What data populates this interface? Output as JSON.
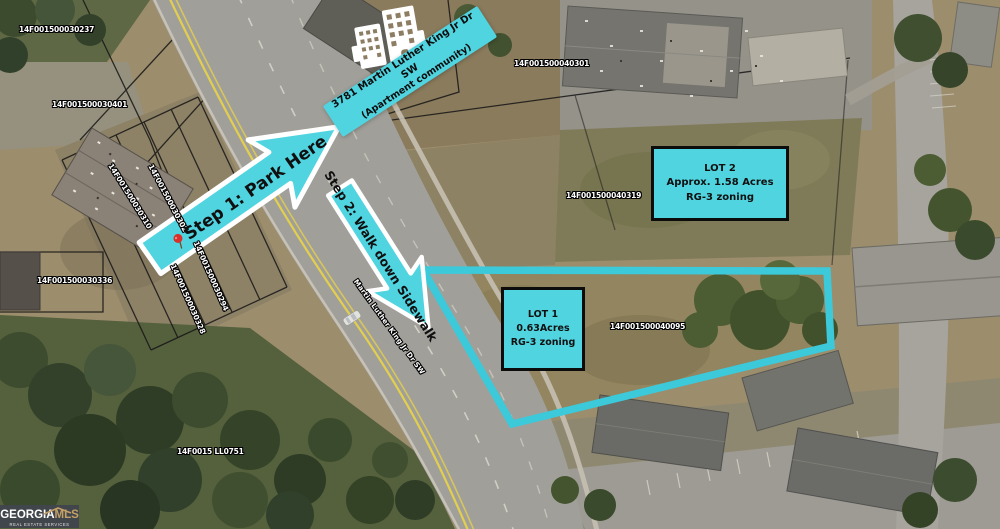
{
  "colors": {
    "accent": "#50d4e0",
    "accent_stroke": "#3cc9da",
    "logo_bg": "#41464c",
    "logo_gold": "#c3a066"
  },
  "parcels": {
    "horizontal": [
      {
        "id": "14F001500030237"
      },
      {
        "id": "14F001500030401"
      },
      {
        "id": "14F001500040301"
      },
      {
        "id": "14F001500040319"
      },
      {
        "id": "14F001500040095"
      },
      {
        "id": "14F001500030336"
      },
      {
        "id": "14F0015 LL0751"
      }
    ],
    "rotated": [
      {
        "id": "14F001500030310"
      },
      {
        "id": "14F001500030302"
      },
      {
        "id": "14F001500030328"
      },
      {
        "id": "14F001500030294"
      }
    ]
  },
  "street": {
    "name": "Martin Luther King Jr Dr SW"
  },
  "apartment_callout": {
    "line1": "3781 Martin Luther King Jr Dr SW",
    "line2": "(Apartment community)"
  },
  "steps": {
    "step1": "Step 1: Park Here",
    "step2": "Step 2: Walk down Sidewalk"
  },
  "lots": {
    "lot1": {
      "title": "LOT 1",
      "area": "0.63Acres",
      "zoning": "RG-3 zoning"
    },
    "lot2": {
      "title": "LOT 2",
      "area": "Approx. 1.58 Acres",
      "zoning": "RG-3 zoning"
    }
  },
  "logo": {
    "name": "GEORGIA",
    "suffix": "MLS",
    "tagline": "REAL ESTATE SERVICES"
  }
}
